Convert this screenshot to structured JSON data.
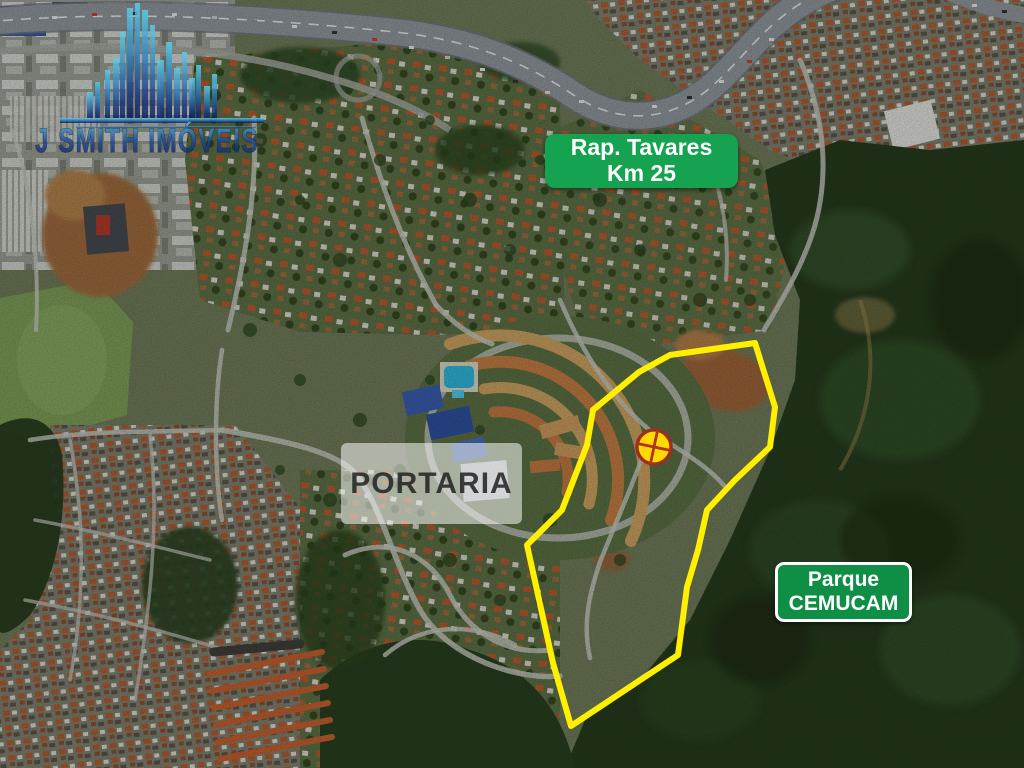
{
  "watermark": {
    "brand": "J SMITH IMÓVEIS",
    "color_dark": "#0A1C55",
    "color_light": "#5BD0EA"
  },
  "signs": {
    "highway": {
      "line1": "Rap. Tavares",
      "line2": "Km 25",
      "bg_color": "#16A351",
      "text_color": "#FFFFFF"
    },
    "gate": {
      "label": "PORTARIA",
      "bg_color": "rgba(255,255,255,0.53)",
      "text_color": "#262626"
    },
    "park": {
      "line1": "Parque",
      "line2": "CEMUCAM",
      "bg_color": "#0F8F46",
      "text_color": "#FFFFFF",
      "border_color": "#FFFFFF"
    }
  },
  "property_outline": {
    "color": "#FFEF00",
    "points": "593,410 639,372 670,355 755,343 775,407 770,447 735,480 707,510 698,550 687,587 678,655 571,726 553,663 527,545 562,510 587,445"
  },
  "marker": {
    "transform": "translate(654,447) rotate(12)",
    "radius": 17,
    "fill": "#FFD900",
    "ring_color": "#9C2E1E",
    "cross_color": "#B03222"
  }
}
